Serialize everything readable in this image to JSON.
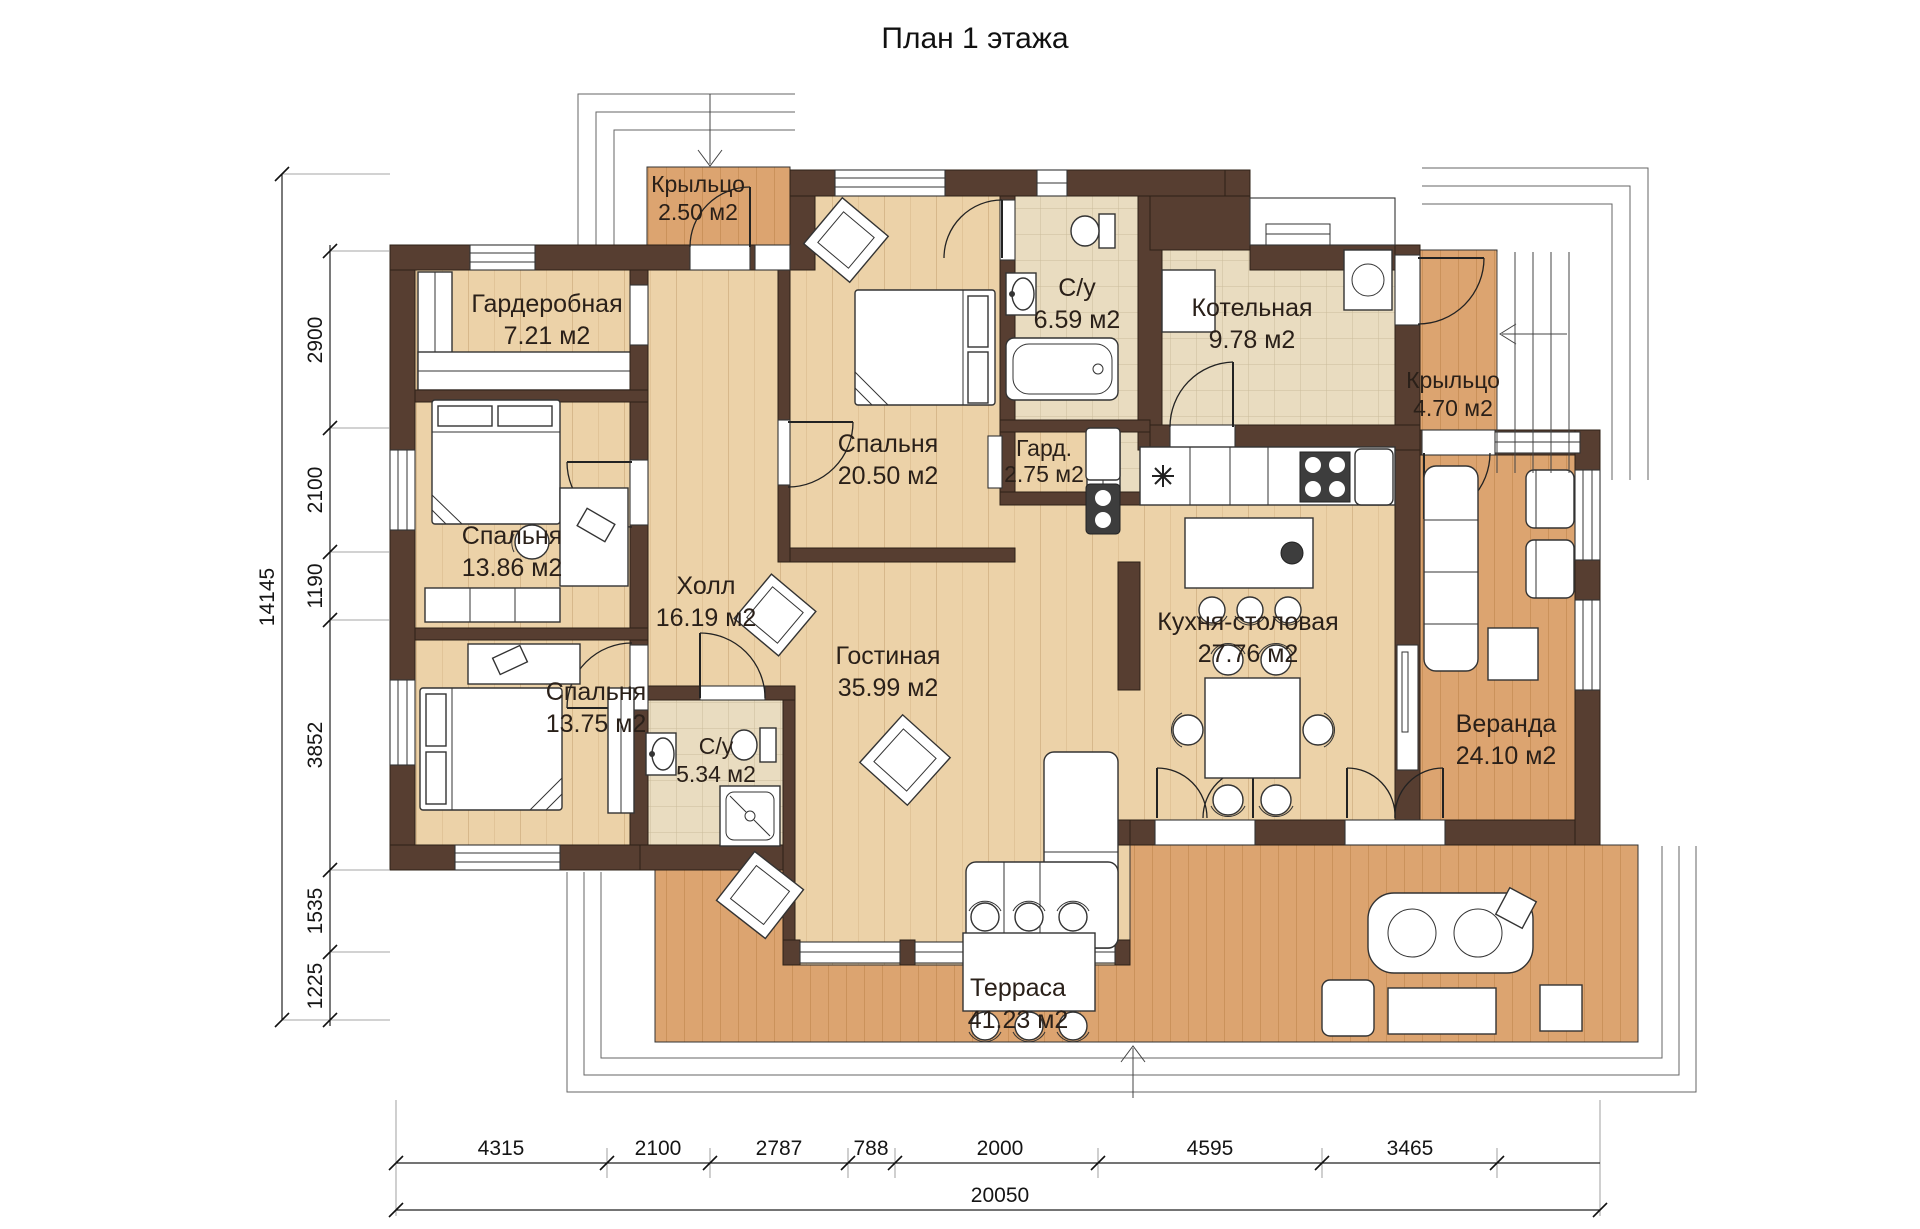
{
  "title": "План 1 этажа",
  "rooms": {
    "porch_top": {
      "name": "Крыльцо",
      "area": "2.50 м2"
    },
    "wardrobe": {
      "name": "Гардеробная",
      "area": "7.21 м2"
    },
    "bathroom_top": {
      "name": "С/у",
      "area": "6.59 м2"
    },
    "boiler": {
      "name": "Котельная",
      "area": "9.78 м2"
    },
    "porch_right": {
      "name": "Крыльцо",
      "area": "4.70 м2"
    },
    "bedroom_top": {
      "name": "Спальня",
      "area": "20.50 м2"
    },
    "closet": {
      "name": "Гард.",
      "area": "2.75 м2"
    },
    "bedroom_mid": {
      "name": "Спальня",
      "area": "13.86 м2"
    },
    "hall": {
      "name": "Холл",
      "area": "16.19 м2"
    },
    "bedroom_bottom": {
      "name": "Спальня",
      "area": "13.75 м2"
    },
    "bathroom_bottom": {
      "name": "С/у",
      "area": "5.34 м2"
    },
    "living": {
      "name": "Гостиная",
      "area": "35.99 м2"
    },
    "kitchen": {
      "name": "Кухня-столовая",
      "area": "27.76 м2"
    },
    "veranda": {
      "name": "Веранда",
      "area": "24.10 м2"
    },
    "terrace": {
      "name": "Терраса",
      "area": "41.23 м2"
    }
  },
  "dimensions": {
    "left": [
      "2900",
      "2100",
      "1190",
      "3852",
      "1535",
      "1225"
    ],
    "left_total": "14145",
    "bottom": [
      "4315",
      "2100",
      "2787",
      "788",
      "2000",
      "4595",
      "3465"
    ],
    "bottom_total": "20050"
  },
  "colors": {
    "wall": "#573e31",
    "wood_floor": "#ecd2a8",
    "deck_floor": "#dca470",
    "tile_floor": "#e9dcc0"
  }
}
